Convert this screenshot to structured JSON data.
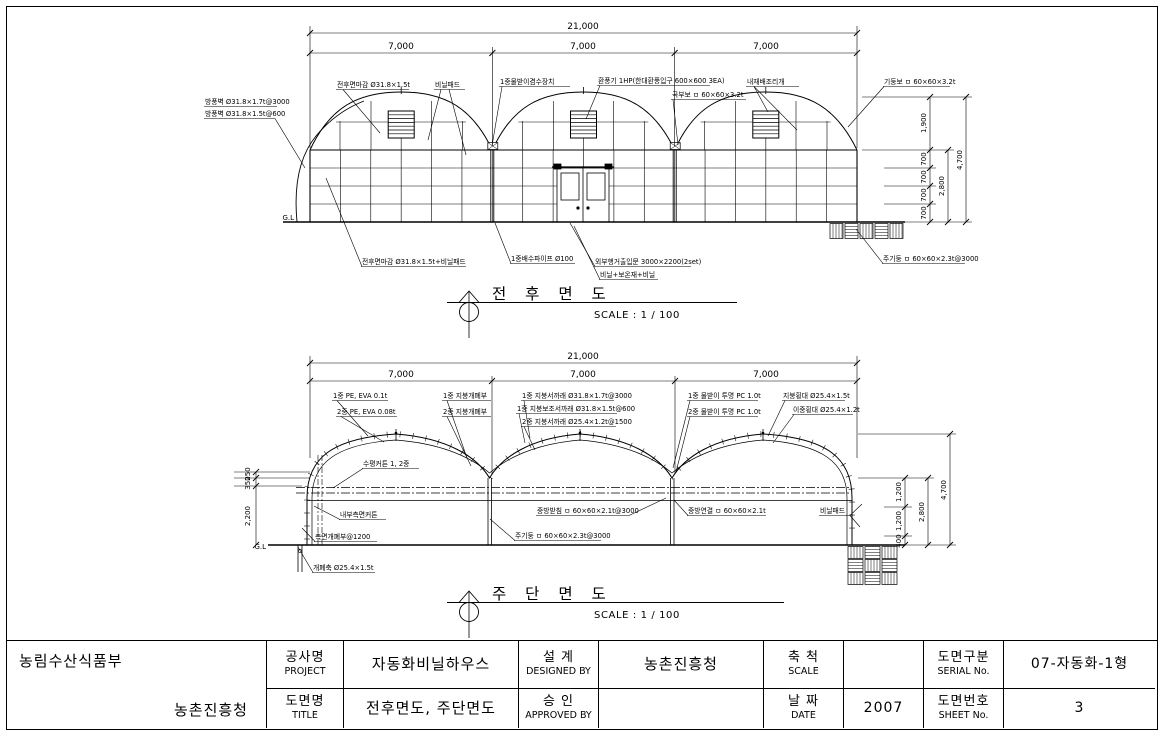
{
  "drawing1": {
    "title": "전 후 면 도",
    "scale": "SCALE : 1 / 100",
    "gl": "G.L",
    "dim_total": "21,000",
    "dim_span": "7,000",
    "dim_right": {
      "v1900": "1,900",
      "v700": "700",
      "v2800": "2,800",
      "v4700": "4,700"
    },
    "labels": {
      "windbreak1": "방풍벽 Ø31.8×1.7t@3000",
      "windbreak2": "방풍벽 Ø31.8×1.5t@600",
      "front_finish": "전후면마감 Ø31.8×1.5t",
      "vinyl_pad": "비닐패드",
      "gutter_device": "1중물받이겸수장치",
      "fan": "환풍기 1HP(한대환풍입구 600×600 3EA)",
      "curve_beam": "곡부보 ㅁ 60×60×3.2t",
      "inner_vent": "내재배조리개",
      "column_beam": "기둥보 ㅁ 60×60×3.2t",
      "front_finish_pad": "전후면마감 Ø31.8×1.5t+비닐패드",
      "drain_pipe": "1중배수파이프 Ø100",
      "door": "외부행거출입문 3000×2200(2set)",
      "vinyl_layers": "비닐+보온재+비닐",
      "main_post": "주기둥 ㅁ 60×60×2.3t@3000"
    }
  },
  "drawing2": {
    "title": "주 단 면 도",
    "scale": "SCALE : 1 / 100",
    "gl": "G.L",
    "dim_total": "21,000",
    "dim_span": "7,000",
    "dim_left": {
      "v250": "250",
      "v350": "350",
      "v2200": "2,200"
    },
    "dim_right": {
      "v1200": "1,200",
      "v400": "400",
      "v2800": "2,800",
      "v4700": "4,700"
    },
    "labels": {
      "pe1": "1중 PE, EVA 0.1t",
      "pe2": "2중 PE, EVA 0.08t",
      "roof_open1": "1중 지붕개폐부",
      "roof_open2": "2중 지붕개폐부",
      "rafter1": "1중 지붕서까래 Ø31.8×1.7t@3000",
      "rafter1b": "1중 지붕보조서까래 Ø31.8×1.5t@600",
      "rafter2": "2중 지붕서까래 Ø25.4×1.2t@1500",
      "gutter1": "1중 물받이 투명 PC 1.0t",
      "gutter2": "2중 물받이 투명 PC 1.0t",
      "roof_bar1": "지붕횡대 Ø25.4×1.5t",
      "roof_bar2": "이중횡대 Ø25.4×1.2t",
      "curtain": "수평커튼 1, 2중",
      "side_curtain": "내부측면커튼",
      "side_open": "측면개폐부@1200",
      "mid_support": "중방받침 ㅁ 60×60×2.1t@3000",
      "main_post": "주기둥 ㅁ 60×60×2.3t@3000",
      "mid_connect": "중방연결 ㅁ 60×60×2.1t",
      "vinyl_pad": "비닐패드",
      "open_shaft": "개폐축 Ø25.4×1.5t"
    }
  },
  "title_block": {
    "org_top": "농림수산식품부",
    "org_bottom": "농촌진흥청",
    "project_label_kr": "공사명",
    "project_label_en": "PROJECT",
    "project_value": "자동화비닐하우스",
    "title_label_kr": "도면명",
    "title_label_en": "TITLE",
    "title_value": "전후면도, 주단면도",
    "designed_label_kr": "설 계",
    "designed_label_en": "DESIGNED BY",
    "designed_value": "농촌진흥청",
    "approved_label_kr": "승 인",
    "approved_label_en": "APPROVED BY",
    "approved_value": "",
    "scale_label_kr": "축 척",
    "scale_label_en": "SCALE",
    "scale_value": "",
    "date_label_kr": "날 짜",
    "date_label_en": "DATE",
    "date_value": "2007",
    "serial_label_kr": "도면구분",
    "serial_label_en": "SERIAL No.",
    "serial_value": "07-자동화-1형",
    "sheet_label_kr": "도면번호",
    "sheet_label_en": "SHEET No.",
    "sheet_value": "3"
  }
}
